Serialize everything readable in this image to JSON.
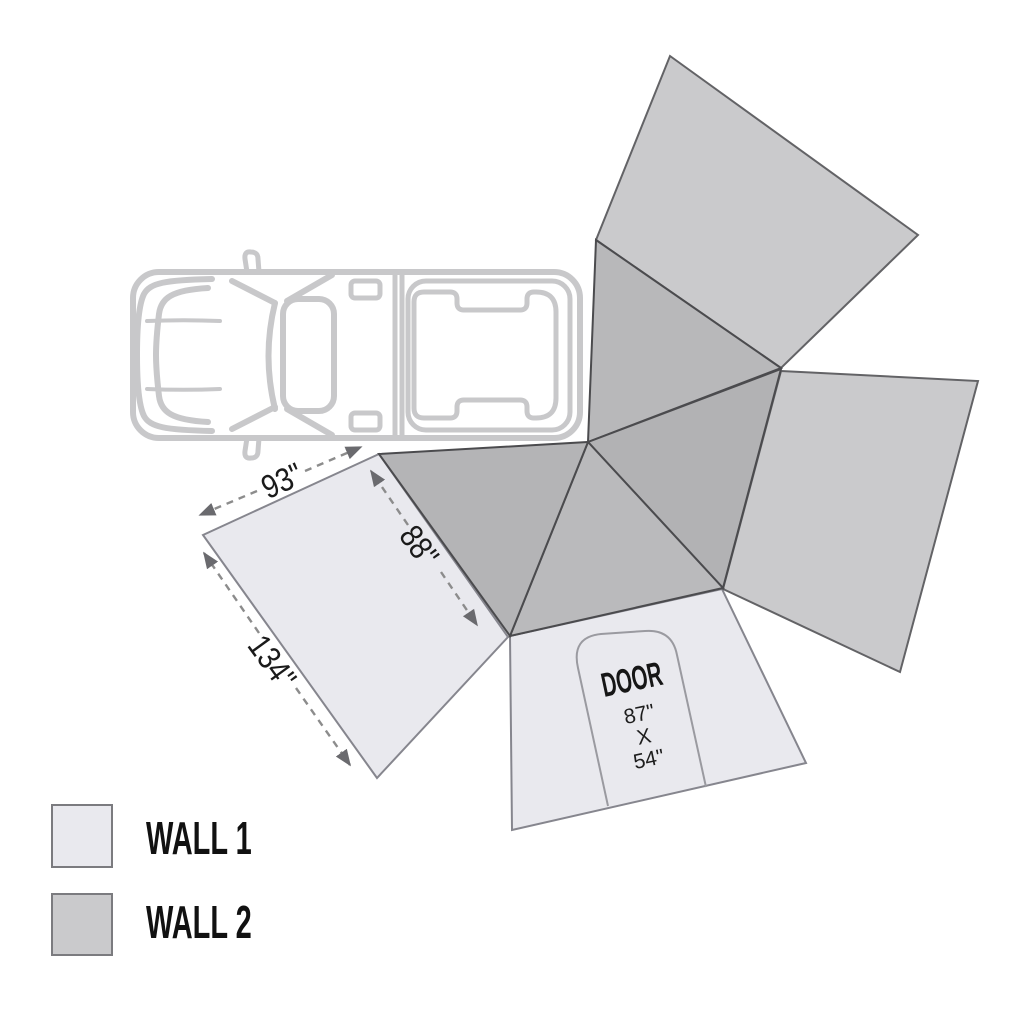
{
  "diagram": {
    "title": "awning-wall-layout",
    "dimensions": {
      "side": "93\"",
      "panel": "88\"",
      "length": "134\""
    },
    "door": {
      "label": "DOOR",
      "height": "87\"",
      "times": "X",
      "width": "54\""
    },
    "legend": [
      {
        "label": "WALL 1",
        "color": "#e9e9ee"
      },
      {
        "label": "WALL 2",
        "color": "#cacacc"
      }
    ],
    "colors": {
      "wall1": "#e9e9ee",
      "wall2": "#cacacc",
      "canopy": "#b5b5b7",
      "panel_outline": "#5a5a5e",
      "vehicle_outline": "#c8c8ca",
      "arrow": "#8c8c8c",
      "text": "#161616"
    }
  }
}
